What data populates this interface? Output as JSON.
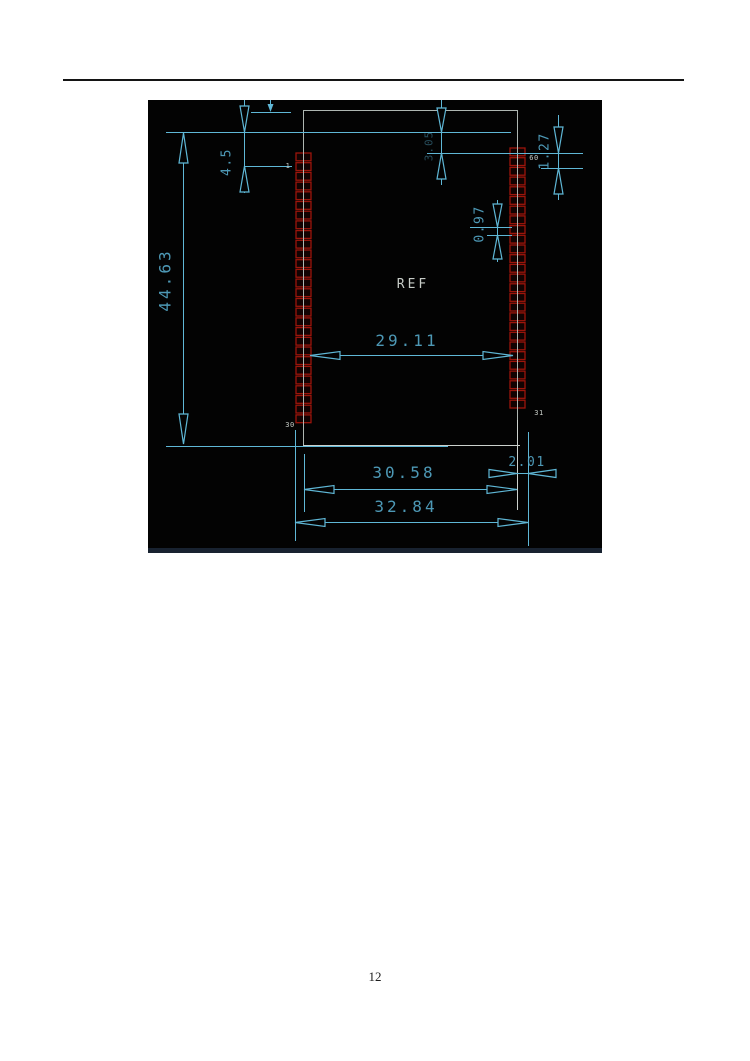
{
  "page": {
    "number": "12"
  },
  "drawing": {
    "ref_label": "REF",
    "dims": {
      "total_height": "44.63",
      "top_offset": "4.5",
      "top_pad_offset": "3.05",
      "pin_pitch": "1.27",
      "pad_width": "0.97",
      "inner_span": "29.11",
      "outer_span": "30.58",
      "pad_length": "2.01",
      "total_width": "32.84"
    },
    "pin_labels": {
      "first_left": "1",
      "last_left": "30",
      "last_right": "31",
      "first_right": "60"
    },
    "colors": {
      "dimension_line": "#5fb7d6",
      "dimension_text": "#55a9c9",
      "pad_outline": "#9c150b",
      "body_outline": "#aeb6b1",
      "white_line": "#ccd1cd",
      "canvas": "#030303",
      "bottom_strip": "#182230"
    },
    "pads": {
      "left": {
        "x": 148,
        "y": 53,
        "count": 28,
        "pitch": 9.7,
        "width": 15,
        "height": 7.8
      },
      "right": {
        "x": 362,
        "y": 48,
        "count": 27,
        "pitch": 9.7,
        "width": 15,
        "height": 7.8
      }
    }
  }
}
